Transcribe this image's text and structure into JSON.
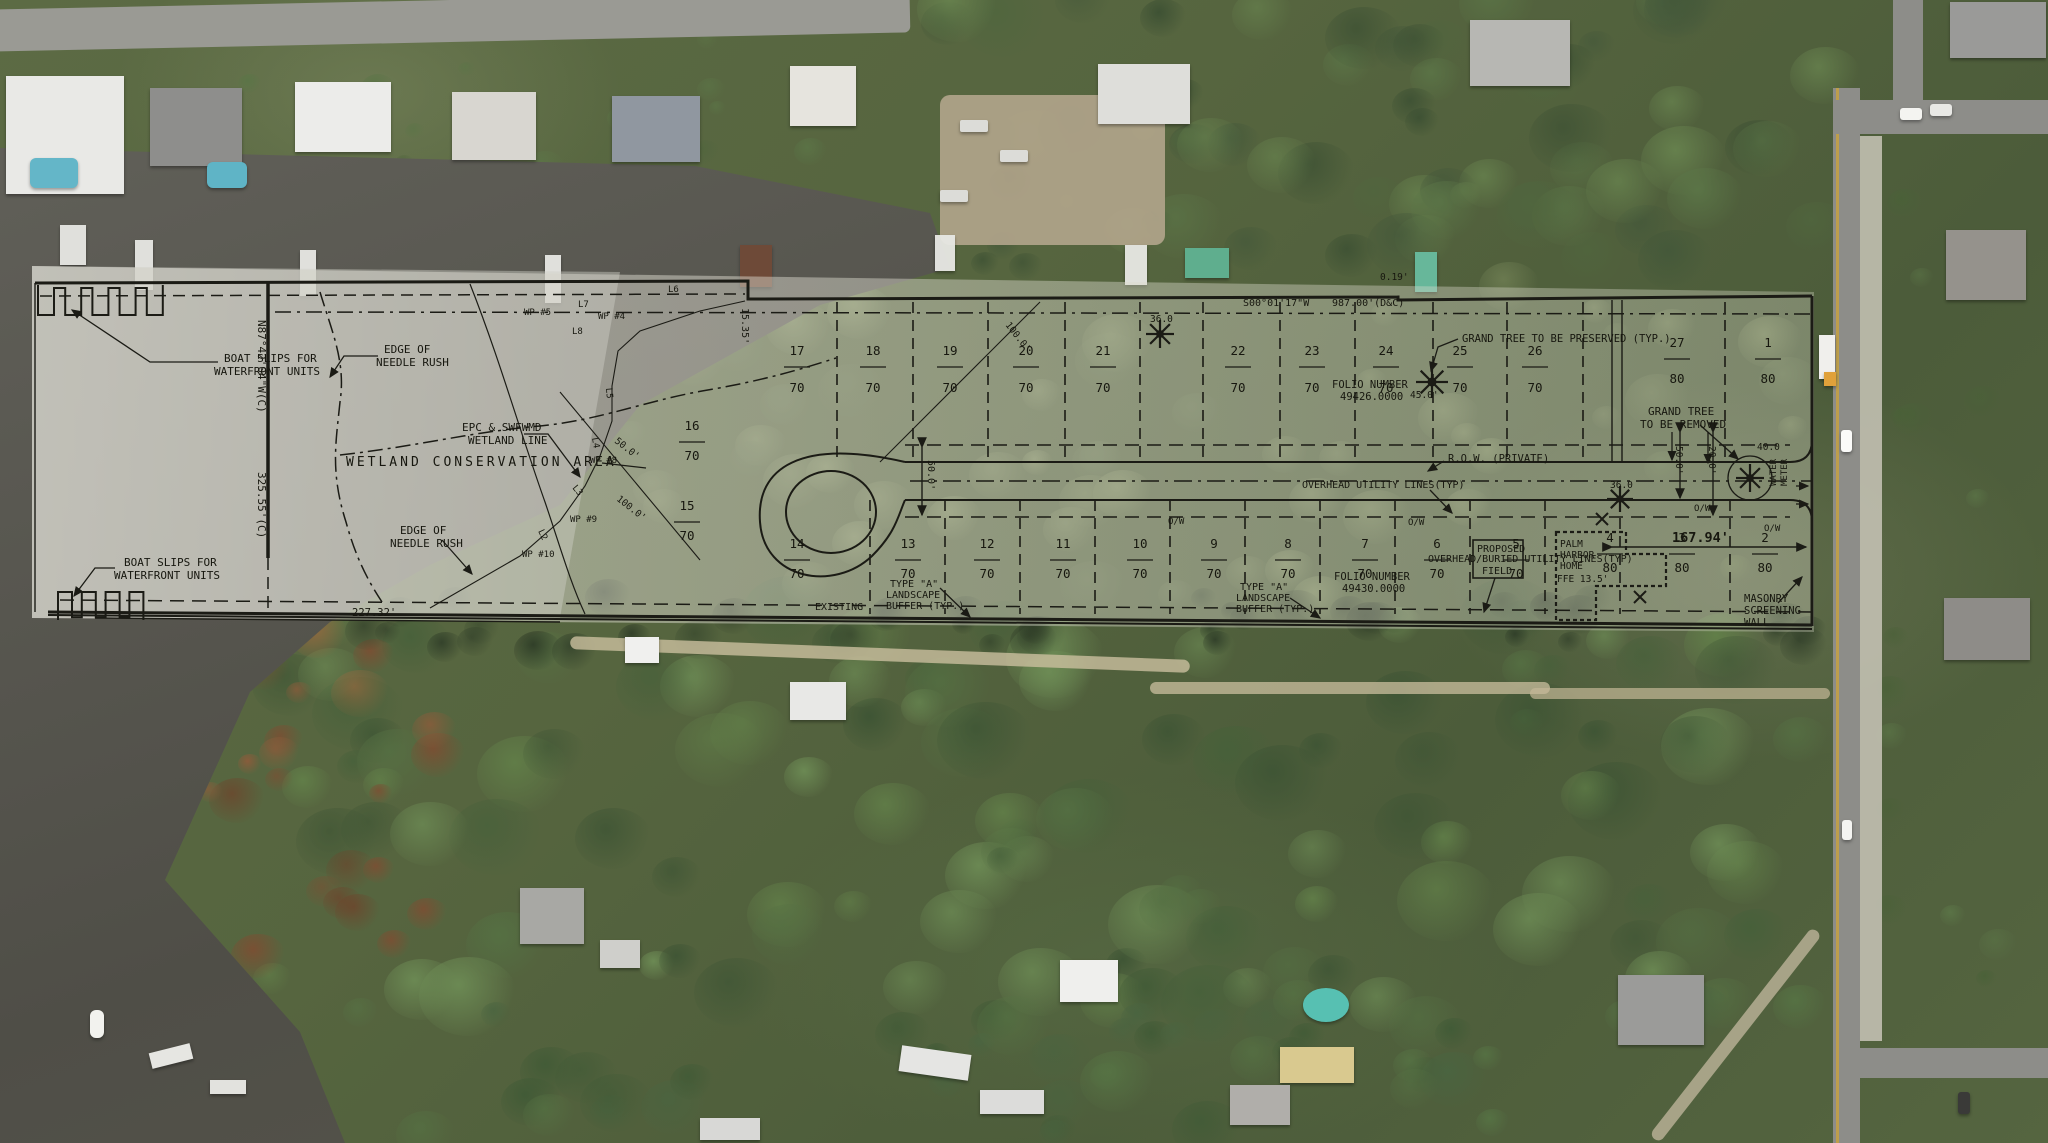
{
  "map": {
    "description": "Aerial photograph with subdivision site plan overlay"
  },
  "plan": {
    "labels": {
      "boat_slips_1": "BOAT SLIPS FOR",
      "boat_slips_2": "WATERFRONT UNITS",
      "edge_of": "EDGE OF",
      "needle_rush": "NEEDLE RUSH",
      "epc_1": "EPC & SWFWMD",
      "epc_2": "WETLAND LINE",
      "wetland_area": "WETLAND CONSERVATION AREA",
      "grand_tree_preserved": "GRAND TREE TO BE PRESERVED (TYP.)",
      "grand_tree_removed_1": "GRAND TREE",
      "grand_tree_removed_2": "TO BE REMOVED",
      "folio_label": "FOLIO NUMBER",
      "folio_north": "49426.0000",
      "folio_south": "49430.0000",
      "row_private": "R.O.W. (PRIVATE)",
      "overhead_utility": "OVERHEAD UTILITY LINES(TYP)",
      "overhead_buried": "OVERHEAD/BURIED UTILITY LINES(TYP)",
      "proposed": "PROPOSED",
      "field": "FIELD",
      "palm": "PALM",
      "harbor": "HARBOR",
      "home": "HOME",
      "ffe": "FFE 13.5'",
      "masonry_1": "MASONRY",
      "masonry_2": "SCREENING",
      "masonry_3": "WALL",
      "water_meter_1": "WATER",
      "water_meter_2": "METER",
      "type_a_1": "TYPE \"A\"",
      "type_a_2": "LANDSCAPE",
      "type_a_3": "BUFFER (TYP.)",
      "existing": "EXISTING",
      "ow": "O/W"
    },
    "bearings": {
      "west_1": "N87°42'04\"W(C)",
      "west_2": "325.55'(C)",
      "north_1": "S00°01'17\"W",
      "north_2": "987.00'(D&C)"
    },
    "dimensions": {
      "south": "227.32'",
      "east": "167.94'",
      "jog": "0.19'",
      "d1535": "15.35'",
      "d50": "50.0'",
      "d100": "100.0'",
      "d20": "20.0'",
      "d40": "40.0",
      "d45": "45.0'",
      "d36": "36.0"
    },
    "waypoints": [
      "WP #4",
      "WP #5",
      "WP #8",
      "WP #9",
      "WP #10"
    ],
    "line_tags": [
      "L2",
      "L3",
      "L4",
      "L5",
      "L6",
      "L7",
      "L8"
    ],
    "lots": {
      "top": [
        {
          "num": "17",
          "size": "70"
        },
        {
          "num": "18",
          "size": "70"
        },
        {
          "num": "19",
          "size": "70"
        },
        {
          "num": "20",
          "size": "70"
        },
        {
          "num": "21",
          "size": "70"
        },
        {
          "num": "22",
          "size": "70"
        },
        {
          "num": "23",
          "size": "70"
        },
        {
          "num": "24",
          "size": "70"
        },
        {
          "num": "25",
          "size": "70"
        },
        {
          "num": "26",
          "size": "70"
        },
        {
          "num": "27",
          "size": "80"
        },
        {
          "num": "1",
          "size": "80"
        }
      ],
      "bottom": [
        {
          "num": "14",
          "size": "70"
        },
        {
          "num": "13",
          "size": "70"
        },
        {
          "num": "12",
          "size": "70"
        },
        {
          "num": "11",
          "size": "70"
        },
        {
          "num": "10",
          "size": "70"
        },
        {
          "num": "9",
          "size": "70"
        },
        {
          "num": "8",
          "size": "70"
        },
        {
          "num": "7",
          "size": "70"
        },
        {
          "num": "6",
          "size": "70"
        },
        {
          "num": "5",
          "size": "70"
        },
        {
          "num": "4",
          "size": "80"
        },
        {
          "num": "3",
          "size": "80"
        },
        {
          "num": "2",
          "size": "80"
        }
      ],
      "side": [
        {
          "num": "15",
          "size": "70"
        },
        {
          "num": "16",
          "size": "70"
        }
      ]
    },
    "colors": {
      "ink": "#1b1b15",
      "film": "#e6e4da",
      "road_yellow": "#c9a23d"
    }
  }
}
